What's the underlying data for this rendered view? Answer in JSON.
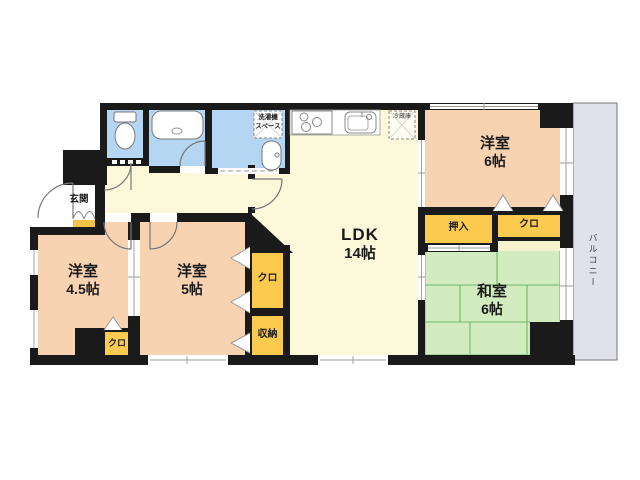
{
  "title": "マンション間取り図",
  "rooms": {
    "ldk": {
      "name": "LDK",
      "size": "14帖"
    },
    "western6": {
      "name": "洋室",
      "size": "6帖"
    },
    "western5": {
      "name": "洋室",
      "size": "5帖"
    },
    "western45": {
      "name": "洋室",
      "size": "4.5帖"
    },
    "japanese6": {
      "name": "和室",
      "size": "6帖"
    }
  },
  "labels": {
    "genkan": "玄関",
    "oshiire": "押入",
    "closet6": "クロ",
    "closet5": "クロ",
    "closet45": "クロ",
    "storage": "収納",
    "balcony": "バルコニー",
    "laundry_line1": "洗濯機",
    "laundry_line2": "スペース",
    "fridge": "冷蔵庫"
  },
  "colors": {
    "wall": "#1a1a1a",
    "western_room": "#f8d3b2",
    "tatami": "#d2ebbf",
    "tatami_line": "#6cb86c",
    "ldk": "#fcf8da",
    "closet": "#fbca4e",
    "wet_area": "#b5d6f2",
    "balcony": "#e0e1ea",
    "genkan_step": "#f5c24a",
    "pale_strip": "#f7f3cf"
  }
}
